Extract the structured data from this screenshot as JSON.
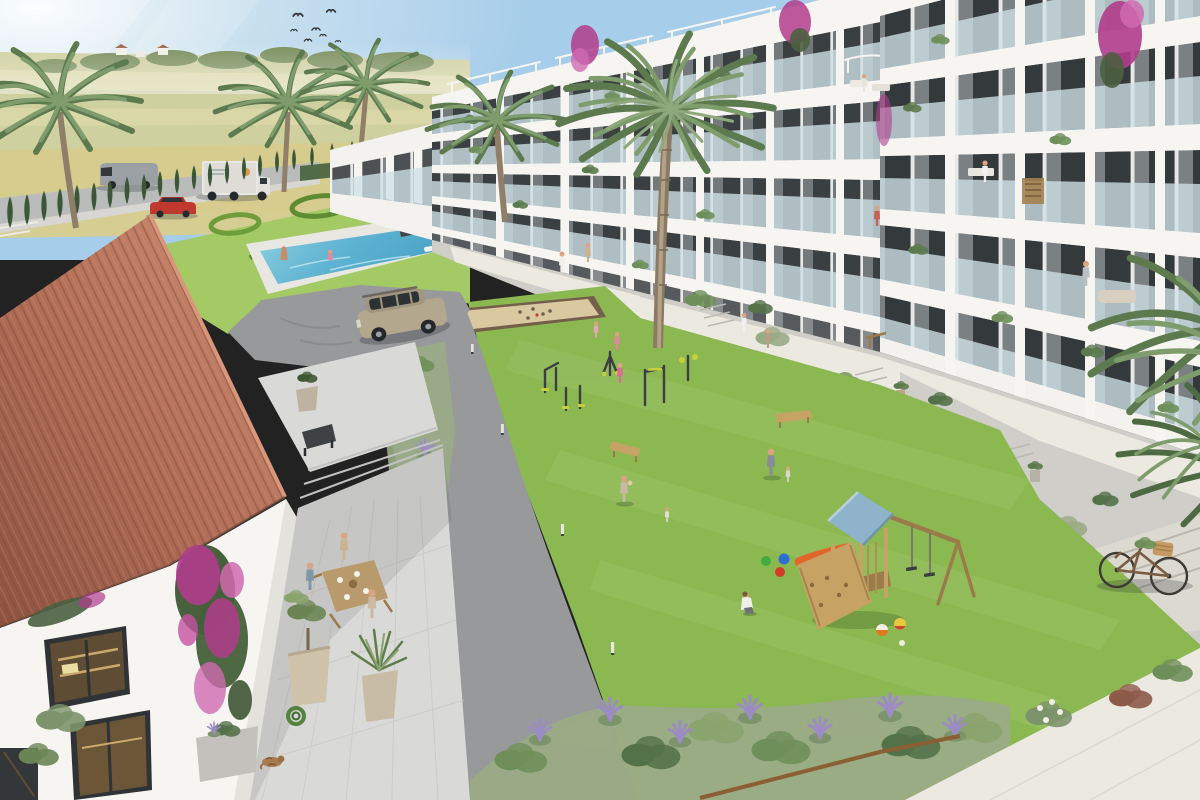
{
  "scene": {
    "description": "Aerial 3D architectural rendering of a modern Mediterranean residential complex: white multi-storey apartment buildings with glass balconies on the right, a central green courtyard with a petanque court, outdoor gym equipment and a wooden playground with blue roof, a swimming pool and sculpted hedge lawn upper-left, farm fields and a road with vehicles in the distance, and a terracotta-roofed clubhouse with an outdoor dining terrace in the left foreground.",
    "time_of_day": "sunny midday",
    "objects": [
      "sky",
      "sun-glow",
      "birds",
      "farm-fields",
      "distant-trees",
      "country-road",
      "delivery-truck",
      "gray-van",
      "red-car",
      "cypress-hedge",
      "palm-trees",
      "swimming-pool",
      "water-feature-planter",
      "ornamental-hedge-lawn",
      "apartment-building",
      "balconies",
      "rooftop-pergolas",
      "bougainvillea",
      "balcony-residents",
      "courtyard-lawn",
      "petanque-court",
      "outdoor-gym",
      "benches",
      "playground-tower",
      "swing-set",
      "toy-buckets",
      "balls",
      "asphalt-path",
      "suv-car",
      "bollard-lights",
      "walkway",
      "planters",
      "steps",
      "bicycle",
      "clubhouse-tiled-roof",
      "clubhouse-windows",
      "dining-terrace",
      "dining-table",
      "residents",
      "potted-olive-tree",
      "potted-yucca",
      "garden-hose",
      "sleeping-cat",
      "lavender-beds",
      "white-walkway"
    ]
  },
  "palette": {
    "sky": "#a6cde9",
    "sky_haze": "#eef3f1",
    "sun_glow": "#fdfdfa",
    "field": "#cfd0a0",
    "field_light": "#dfdcae",
    "field_gold": "#d6cc8e",
    "treeline": "#7a8f5d",
    "road": "#b9bcba",
    "cypress": "#3c5737",
    "hedge": "#46603c",
    "palm": "#7f9c6d",
    "palm_dark": "#5c7a4e",
    "trunk": "#9a8a74",
    "pool": "#6ab8d4",
    "pool_deep": "#4aa3c2",
    "deck": "#e9e7e1",
    "grass": "#8cb851",
    "grass_light": "#a3ca64",
    "hedge_art": "#6f9d3c",
    "sand": "#d9c8a0",
    "sand_rim": "#74604a",
    "asphalt": "#97999b",
    "pavement": "#d9d9d7",
    "walkway": "#ece9e1",
    "concrete": "#cfcec8",
    "building": "#f3f2ee",
    "recess": "#74797c",
    "window": "#3a3f42",
    "glass": "#cfe1e7",
    "roof_tile": "#b5705a",
    "roof_dark": "#8e5341",
    "roof_light": "#cd8d72",
    "bougainvillea": "#b13c8c",
    "flower_light": "#d06ab0",
    "lavender": "#988bc2",
    "bush": "#6f8f5a",
    "sage": "#9aab86",
    "wood": "#c7a265",
    "wood_dark": "#9b7b4a",
    "play_roof": "#8fb3ca",
    "slide": "#e0662b",
    "suv": "#b3a78e",
    "car_red": "#c0392f",
    "van": "#9aa0a3",
    "truck": "#e9e8e4",
    "skin": "#dba583",
    "yellow_gym": "#c9cf3a",
    "white_paint": "#f6f5f2",
    "basket": "#c49a62",
    "cat": "#a97c4f"
  }
}
